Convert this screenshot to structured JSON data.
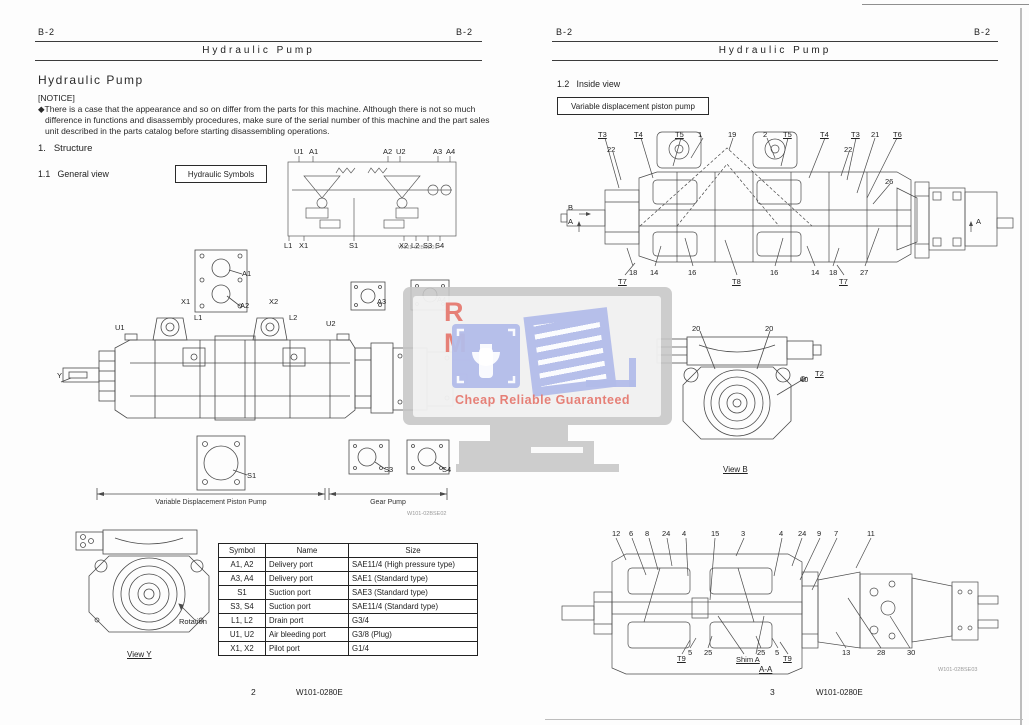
{
  "watermark": {
    "line1": "R M",
    "line2": "Cheap Reliable Guaranteed",
    "red": "#e4736a",
    "blue": "#b2bce9",
    "gray": "#c6c6c6"
  },
  "left_page": {
    "header": {
      "left": "B-2",
      "right": "B-2",
      "title": "Hydraulic Pump"
    },
    "section_title": "Hydraulic Pump",
    "notice_label": "[NOTICE]",
    "notice_text": "◆There is a case that the appearance and so on differ from the parts for this machine. Although there is not so much difference in functions and disassembly procedures, make sure of the serial number of this machine and the part sales unit described in the parts catalog before starting disassembling operations.",
    "heading_structure": "1.   Structure",
    "heading_general_view": "1.1   General view",
    "symbols_box_label": "Hydraulic Symbols",
    "symbols_diagram": {
      "code": "W101-02BSE01",
      "labels": [
        {
          "t": "U1",
          "x": 14,
          "y": 2
        },
        {
          "t": "A1",
          "x": 29,
          "y": 2
        },
        {
          "t": "A2",
          "x": 103,
          "y": 2
        },
        {
          "t": "U2",
          "x": 116,
          "y": 2
        },
        {
          "t": "A3",
          "x": 153,
          "y": 2
        },
        {
          "t": "A4",
          "x": 166,
          "y": 2
        },
        {
          "t": "L1",
          "x": 4,
          "y": 96
        },
        {
          "t": "X1",
          "x": 19,
          "y": 96
        },
        {
          "t": "S1",
          "x": 69,
          "y": 96
        },
        {
          "t": "X2",
          "x": 119,
          "y": 96
        },
        {
          "t": "L2",
          "x": 131,
          "y": 96
        },
        {
          "t": "S3",
          "x": 143,
          "y": 96
        },
        {
          "t": "S4",
          "x": 155,
          "y": 96
        }
      ]
    },
    "general_view": {
      "code": "W101-02BSE02",
      "dim_label_left": "Variable Displacement Piston Pump",
      "dim_label_right": "Gear Pump",
      "labels": [
        {
          "t": "U1",
          "x": 60,
          "y": 76
        },
        {
          "t": "X1",
          "x": 126,
          "y": 50
        },
        {
          "t": "L1",
          "x": 139,
          "y": 66
        },
        {
          "t": "A1",
          "x": 187,
          "y": 22
        },
        {
          "t": "A2",
          "x": 185,
          "y": 54
        },
        {
          "t": "X2",
          "x": 214,
          "y": 50
        },
        {
          "t": "L2",
          "x": 234,
          "y": 66
        },
        {
          "t": "U2",
          "x": 271,
          "y": 72
        },
        {
          "t": "Y",
          "x": 2,
          "y": 124
        },
        {
          "t": "A3",
          "x": 322,
          "y": 50
        },
        {
          "t": "A4",
          "x": 382,
          "y": 48
        },
        {
          "t": "S1",
          "x": 192,
          "y": 224
        },
        {
          "t": "S3",
          "x": 329,
          "y": 218
        },
        {
          "t": "S4",
          "x": 387,
          "y": 218
        }
      ]
    },
    "view_y": {
      "caption": "View Y",
      "labels": [
        {
          "t": "Rotation",
          "x": 104,
          "y": 90
        }
      ]
    },
    "table": {
      "headers": [
        "Symbol",
        "Name",
        "Size"
      ],
      "rows": [
        [
          "A1, A2",
          "Delivery port",
          "SAE11/4 (High pressure type)"
        ],
        [
          "A3, A4",
          "Delivery port",
          "SAE1 (Standard type)"
        ],
        [
          "S1",
          "Suction port",
          "SAE3 (Standard type)"
        ],
        [
          "S3, S4",
          "Suction port",
          "SAE11/4 (Standard type)"
        ],
        [
          "L1, L2",
          "Drain port",
          "G3/4"
        ],
        [
          "U1, U2",
          "Air bleeding port",
          "G3/8 (Plug)"
        ],
        [
          "X1, X2",
          "Pilot port",
          "G1/4"
        ]
      ]
    },
    "footer": {
      "page": "2",
      "doc": "W101-0280E"
    }
  },
  "right_page": {
    "header": {
      "left": "B-2",
      "right": "B-2",
      "title": "Hydraulic Pump"
    },
    "heading_inside_view": "1.2   Inside view",
    "box_label": "Variable displacement piston pump",
    "top_diagram": {
      "labels": [
        {
          "t": "T3",
          "x": 41,
          "y": 13,
          "u": true
        },
        {
          "t": "22",
          "x": 50,
          "y": 28
        },
        {
          "t": "T4",
          "x": 77,
          "y": 13,
          "u": true
        },
        {
          "t": "T5",
          "x": 118,
          "y": 13,
          "u": true
        },
        {
          "t": "1",
          "x": 141,
          "y": 13
        },
        {
          "t": "19",
          "x": 171,
          "y": 13
        },
        {
          "t": "2",
          "x": 206,
          "y": 13
        },
        {
          "t": "T5",
          "x": 226,
          "y": 13,
          "u": true
        },
        {
          "t": "T4",
          "x": 263,
          "y": 13,
          "u": true
        },
        {
          "t": "T3",
          "x": 294,
          "y": 13,
          "u": true
        },
        {
          "t": "22",
          "x": 287,
          "y": 28
        },
        {
          "t": "21",
          "x": 314,
          "y": 13
        },
        {
          "t": "T6",
          "x": 336,
          "y": 13,
          "u": true
        },
        {
          "t": "26",
          "x": 328,
          "y": 60
        },
        {
          "t": "B",
          "x": 11,
          "y": 86
        },
        {
          "t": "A",
          "x": 11,
          "y": 100
        },
        {
          "t": "A",
          "x": 419,
          "y": 100
        },
        {
          "t": "18",
          "x": 72,
          "y": 151
        },
        {
          "t": "T7",
          "x": 61,
          "y": 160,
          "u": true
        },
        {
          "t": "14",
          "x": 93,
          "y": 151
        },
        {
          "t": "16",
          "x": 131,
          "y": 151
        },
        {
          "t": "T8",
          "x": 175,
          "y": 160,
          "u": true
        },
        {
          "t": "16",
          "x": 213,
          "y": 151
        },
        {
          "t": "14",
          "x": 254,
          "y": 151
        },
        {
          "t": "18",
          "x": 272,
          "y": 151
        },
        {
          "t": "T7",
          "x": 282,
          "y": 160,
          "u": true
        },
        {
          "t": "27",
          "x": 303,
          "y": 151
        }
      ]
    },
    "view_b": {
      "caption": "View B",
      "labels": [
        {
          "t": "20",
          "x": 37,
          "y": 12
        },
        {
          "t": "20",
          "x": 110,
          "y": 12
        },
        {
          "t": "40",
          "x": 145,
          "y": 63
        },
        {
          "t": "T2",
          "x": 160,
          "y": 57,
          "u": true
        }
      ]
    },
    "section_aa": {
      "caption": "A-A",
      "code": "W101-02BSE03",
      "labels": [
        {
          "t": "12",
          "x": 52,
          "y": 10
        },
        {
          "t": "6",
          "x": 69,
          "y": 10
        },
        {
          "t": "8",
          "x": 85,
          "y": 10
        },
        {
          "t": "24",
          "x": 102,
          "y": 10
        },
        {
          "t": "4",
          "x": 122,
          "y": 10
        },
        {
          "t": "15",
          "x": 151,
          "y": 10
        },
        {
          "t": "3",
          "x": 181,
          "y": 10
        },
        {
          "t": "4",
          "x": 219,
          "y": 10
        },
        {
          "t": "24",
          "x": 238,
          "y": 10
        },
        {
          "t": "9",
          "x": 257,
          "y": 10
        },
        {
          "t": "7",
          "x": 274,
          "y": 10
        },
        {
          "t": "11",
          "x": 307,
          "y": 10
        },
        {
          "t": "T9",
          "x": 117,
          "y": 135,
          "u": true
        },
        {
          "t": "5",
          "x": 128,
          "y": 129
        },
        {
          "t": "25",
          "x": 144,
          "y": 129
        },
        {
          "t": "Shim A",
          "x": 176,
          "y": 136,
          "u": true
        },
        {
          "t": "25",
          "x": 197,
          "y": 129
        },
        {
          "t": "5",
          "x": 215,
          "y": 129
        },
        {
          "t": "T9",
          "x": 223,
          "y": 135,
          "u": true
        },
        {
          "t": "13",
          "x": 282,
          "y": 129
        },
        {
          "t": "28",
          "x": 317,
          "y": 129
        },
        {
          "t": "30",
          "x": 347,
          "y": 129
        }
      ]
    },
    "footer": {
      "page": "3",
      "doc": "W101-0280E"
    }
  }
}
